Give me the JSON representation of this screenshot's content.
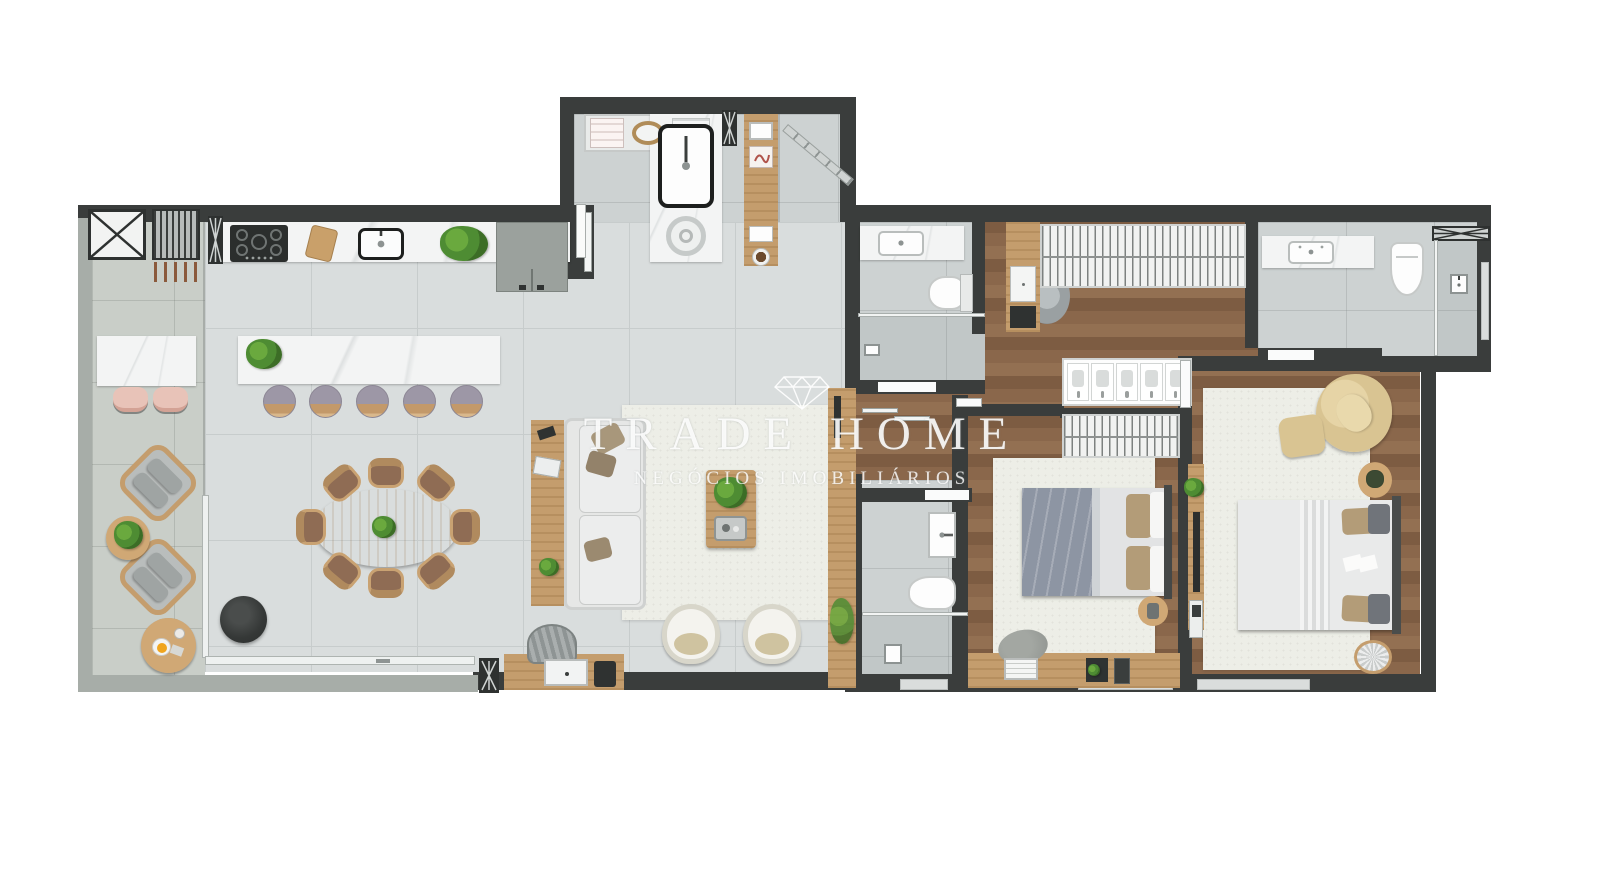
{
  "watermark": {
    "brand": "TRADE HOME",
    "tagline": "NEGÓCIOS IMOBILIÁRIOS",
    "icon": "diamond"
  },
  "palette": {
    "background": "#ffffff",
    "wall": "#3a3d3c",
    "wall_light": "#a7ada8",
    "tile": "#d9dddd",
    "tile_line": "#c7cccc",
    "balcony": "#c9cec8",
    "bath_tile": "#cdd2d2",
    "wood_floor": "#8a674b",
    "wood": "#c49d6d",
    "marble": "#f3f4f4",
    "rug": "#edeee7",
    "accent_green": "#4e8c33",
    "pink": "#e8c3b8",
    "stool": "#9d97a6",
    "duvet": "#8d95a3",
    "tan_pillow": "#b39c78",
    "cream_chair": "#d9c492",
    "fixture_white": "#fafbfb",
    "dark_object": "#2f3231"
  }
}
